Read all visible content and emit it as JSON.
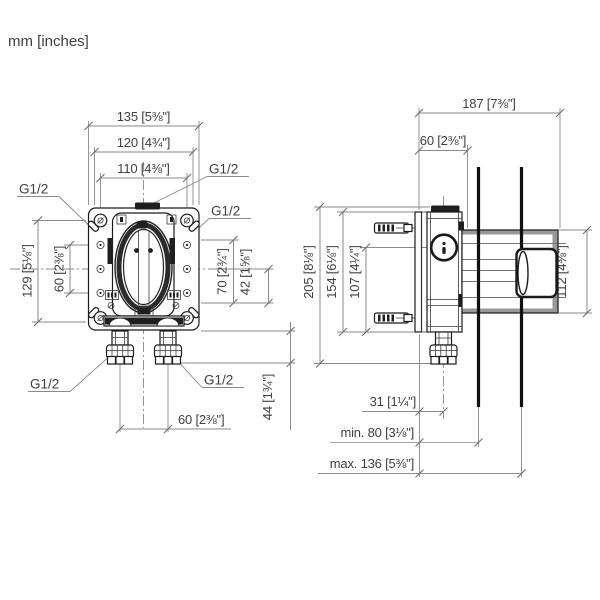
{
  "page": {
    "units_label": "mm [inches]"
  },
  "front_view": {
    "port_thread_label": "G1/2",
    "dimensions": {
      "overall_width": "135 [5⅜\"]",
      "mounting_width": "120 [4¾\"]",
      "screw_width": "110 [4⅜\"]",
      "overall_height": "129 [5⅛\"]",
      "side_hole_spacing": "60 [2⅜\"]",
      "right_upper": "70 [2¾\"]",
      "right_lower": "42 [1⅝\"]",
      "outlet_spacing": "60 [2⅜\"]",
      "fitting_length": "44 [1¾\"]"
    }
  },
  "side_view": {
    "dimensions": {
      "overall_depth": "187 [7⅜\"]",
      "housing_depth": "60 [2⅜\"]",
      "overall_height": "205 [8⅛\"]",
      "plate_height": "154 [6⅛\"]",
      "lower_height": "107 [4¼\"]",
      "trim_height": "112 [4⅜\"]",
      "outlet_offset": "31 [1¼\"]",
      "wall_depth_min": "min. 80 [3⅛\"]",
      "wall_depth_max": "max. 136 [5⅜\"]"
    }
  }
}
